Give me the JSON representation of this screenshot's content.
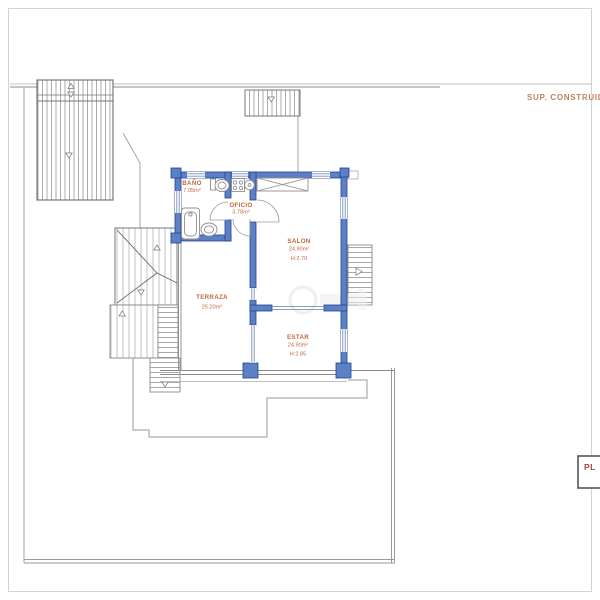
{
  "header": {
    "sup_construida_label": "SUP. CONSTRUID"
  },
  "title_block": {
    "label": "PL"
  },
  "rooms": {
    "bano": {
      "name": "BAÑO",
      "area": "7.05m²"
    },
    "oficio": {
      "name": "OFICIO",
      "area": "3.78m²"
    },
    "salon": {
      "name": "SALON",
      "area": "24.90m²",
      "height": "H:2.70"
    },
    "terraza": {
      "name": "TERRAZA",
      "area": "25.20m²"
    },
    "estar": {
      "name": "ESTAR",
      "area": "24.90m²",
      "height": "H:2.85"
    }
  },
  "colors": {
    "wall_fill": "#5b80c6",
    "wall_stroke": "#24418f",
    "window_line": "#7b8fb8",
    "label_text": "#c2663f",
    "header_text": "#bd8261",
    "title_text": "#a34848",
    "boundary": "#9a9a9a"
  }
}
